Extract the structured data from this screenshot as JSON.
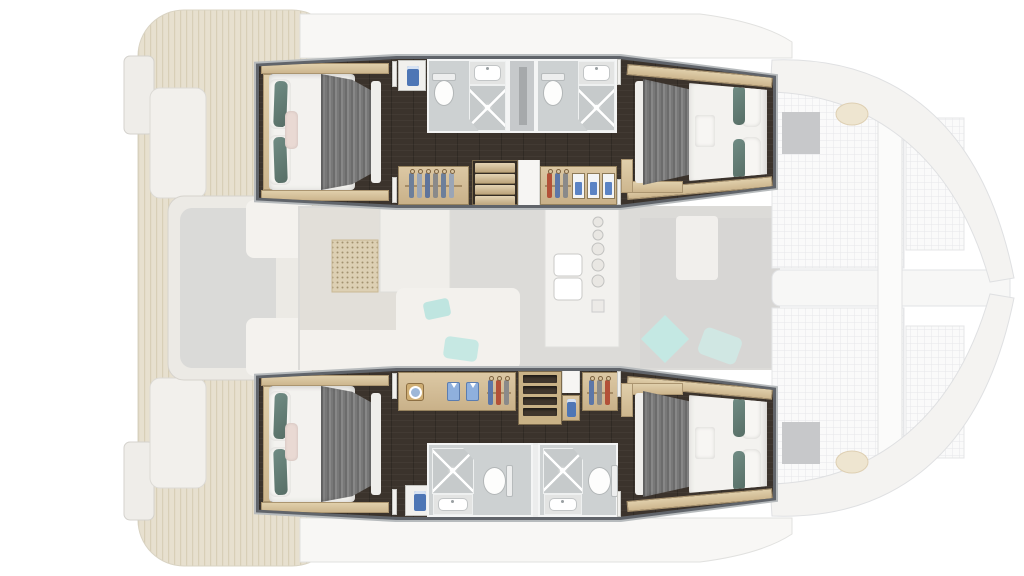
{
  "plan": {
    "type": "yacht-floor-plan",
    "subject": "catamaran interior layout, 4-cabin version",
    "highlighted_region": "hull accommodation decks: four double cabins, four bathrooms with shower, wardrobes, companionway stairs",
    "faded_region": "main deck: aft cockpit with bench seating, saloon with sofa and galley, foredeck with trampolines and deck hatches"
  },
  "suites": [
    {
      "name": "upper-hull-suite",
      "position": "top",
      "rooms": [
        "aft double cabin",
        "bathroom 1 with toilet, sink and shower",
        "technical space",
        "bathroom 2 with toilet, sink and shower",
        "forward double cabin"
      ],
      "features": [
        "towel closet",
        "wardrobe with hangers",
        "staircase",
        "wardrobe with hangers and towel cubbies",
        "desk in forward cabin"
      ]
    },
    {
      "name": "lower-hull-suite",
      "position": "bottom",
      "rooms": [
        "aft double cabin",
        "bathroom 1 with shower, sink and toilet",
        "bathroom 2 with shower, sink and toilet",
        "forward double cabin"
      ],
      "features": [
        "washing-machine",
        "wardrobe with folded shirts and hangers",
        "shelf unit",
        "towel niche",
        "wardrobe with hangers",
        "towel closet",
        "desk in forward cabin"
      ]
    }
  ],
  "ghost_areas": [
    "swim platforms",
    "aft cockpit bench",
    "teak aft deck",
    "saloon sofa",
    "saloon table",
    "perforated cabinet",
    "galley island with double sink and stove dials",
    "forward lounge with cushion",
    "bow trampolines",
    "forward crossbeam",
    "deck hatches",
    "winch pads",
    "hull bows"
  ],
  "colors": {
    "background": "#ffffff",
    "corridor_floor": "#3b332c",
    "wood_trim": "#d2bd96",
    "bathroom_floor": "#cdd1d2",
    "bed_duvet": "#f3f2ef",
    "bed_blanket": "#787878",
    "pillow_teal": "#64807a",
    "pillow_blush": "#e9d9d3",
    "towel_blue": "#4e76b5",
    "suite_outline": "#60646a",
    "ghost_teak": "#e4ddcb",
    "ghost_floor": "#dcdbd8",
    "ghost_teal": "#c2e7e2",
    "hatch_grey": "#c7c8ca"
  },
  "icons": [
    "washing-machine-icon",
    "hanger-icon",
    "toilet-icon",
    "sink-icon",
    "shower-icon",
    "towel-icon",
    "stove-dial-icon"
  ]
}
